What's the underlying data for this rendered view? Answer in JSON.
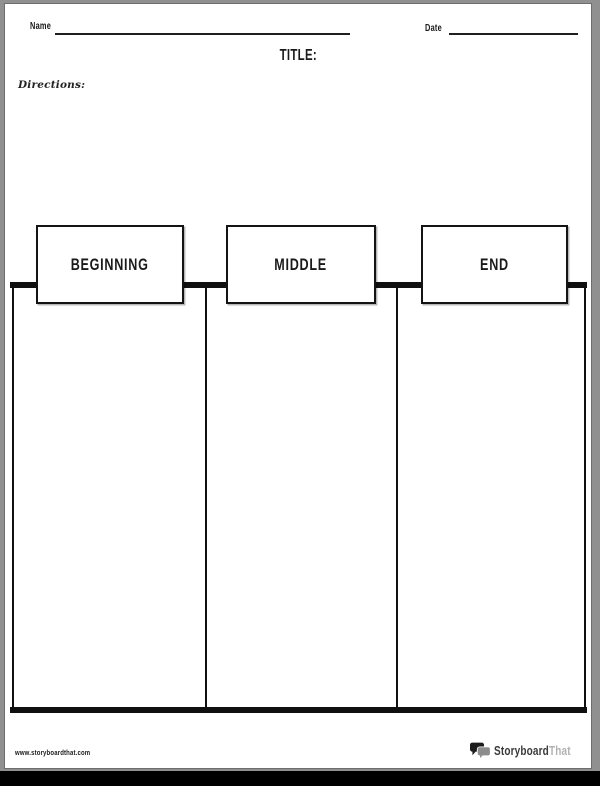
{
  "header": {
    "name_label": "Name",
    "name_value": "",
    "date_label": "Date",
    "date_value": "",
    "title_label": "TITLE:",
    "directions_label": "Directions:",
    "directions_value": ""
  },
  "organizer": {
    "columns": [
      {
        "label": "BEGINNING",
        "content": ""
      },
      {
        "label": "MIDDLE",
        "content": ""
      },
      {
        "label": "END",
        "content": ""
      }
    ]
  },
  "footer": {
    "website_url": "www.storyboardthat.com",
    "logo_text_primary": "Storyboard",
    "logo_text_secondary": "That"
  },
  "icons": {
    "brand_icon": "speech-bubbles-icon"
  },
  "colors": {
    "ink": "#1a1a1a",
    "page_white": "#ffffff",
    "frame_gray": "#909090",
    "bottom_band_black": "#000000",
    "logo_primary_text": "#3a3a3a",
    "logo_secondary_text": "#b1b1b1",
    "logo_bubble_dark": "#1c1c1c",
    "logo_bubble_gray": "#8d8d8d"
  }
}
